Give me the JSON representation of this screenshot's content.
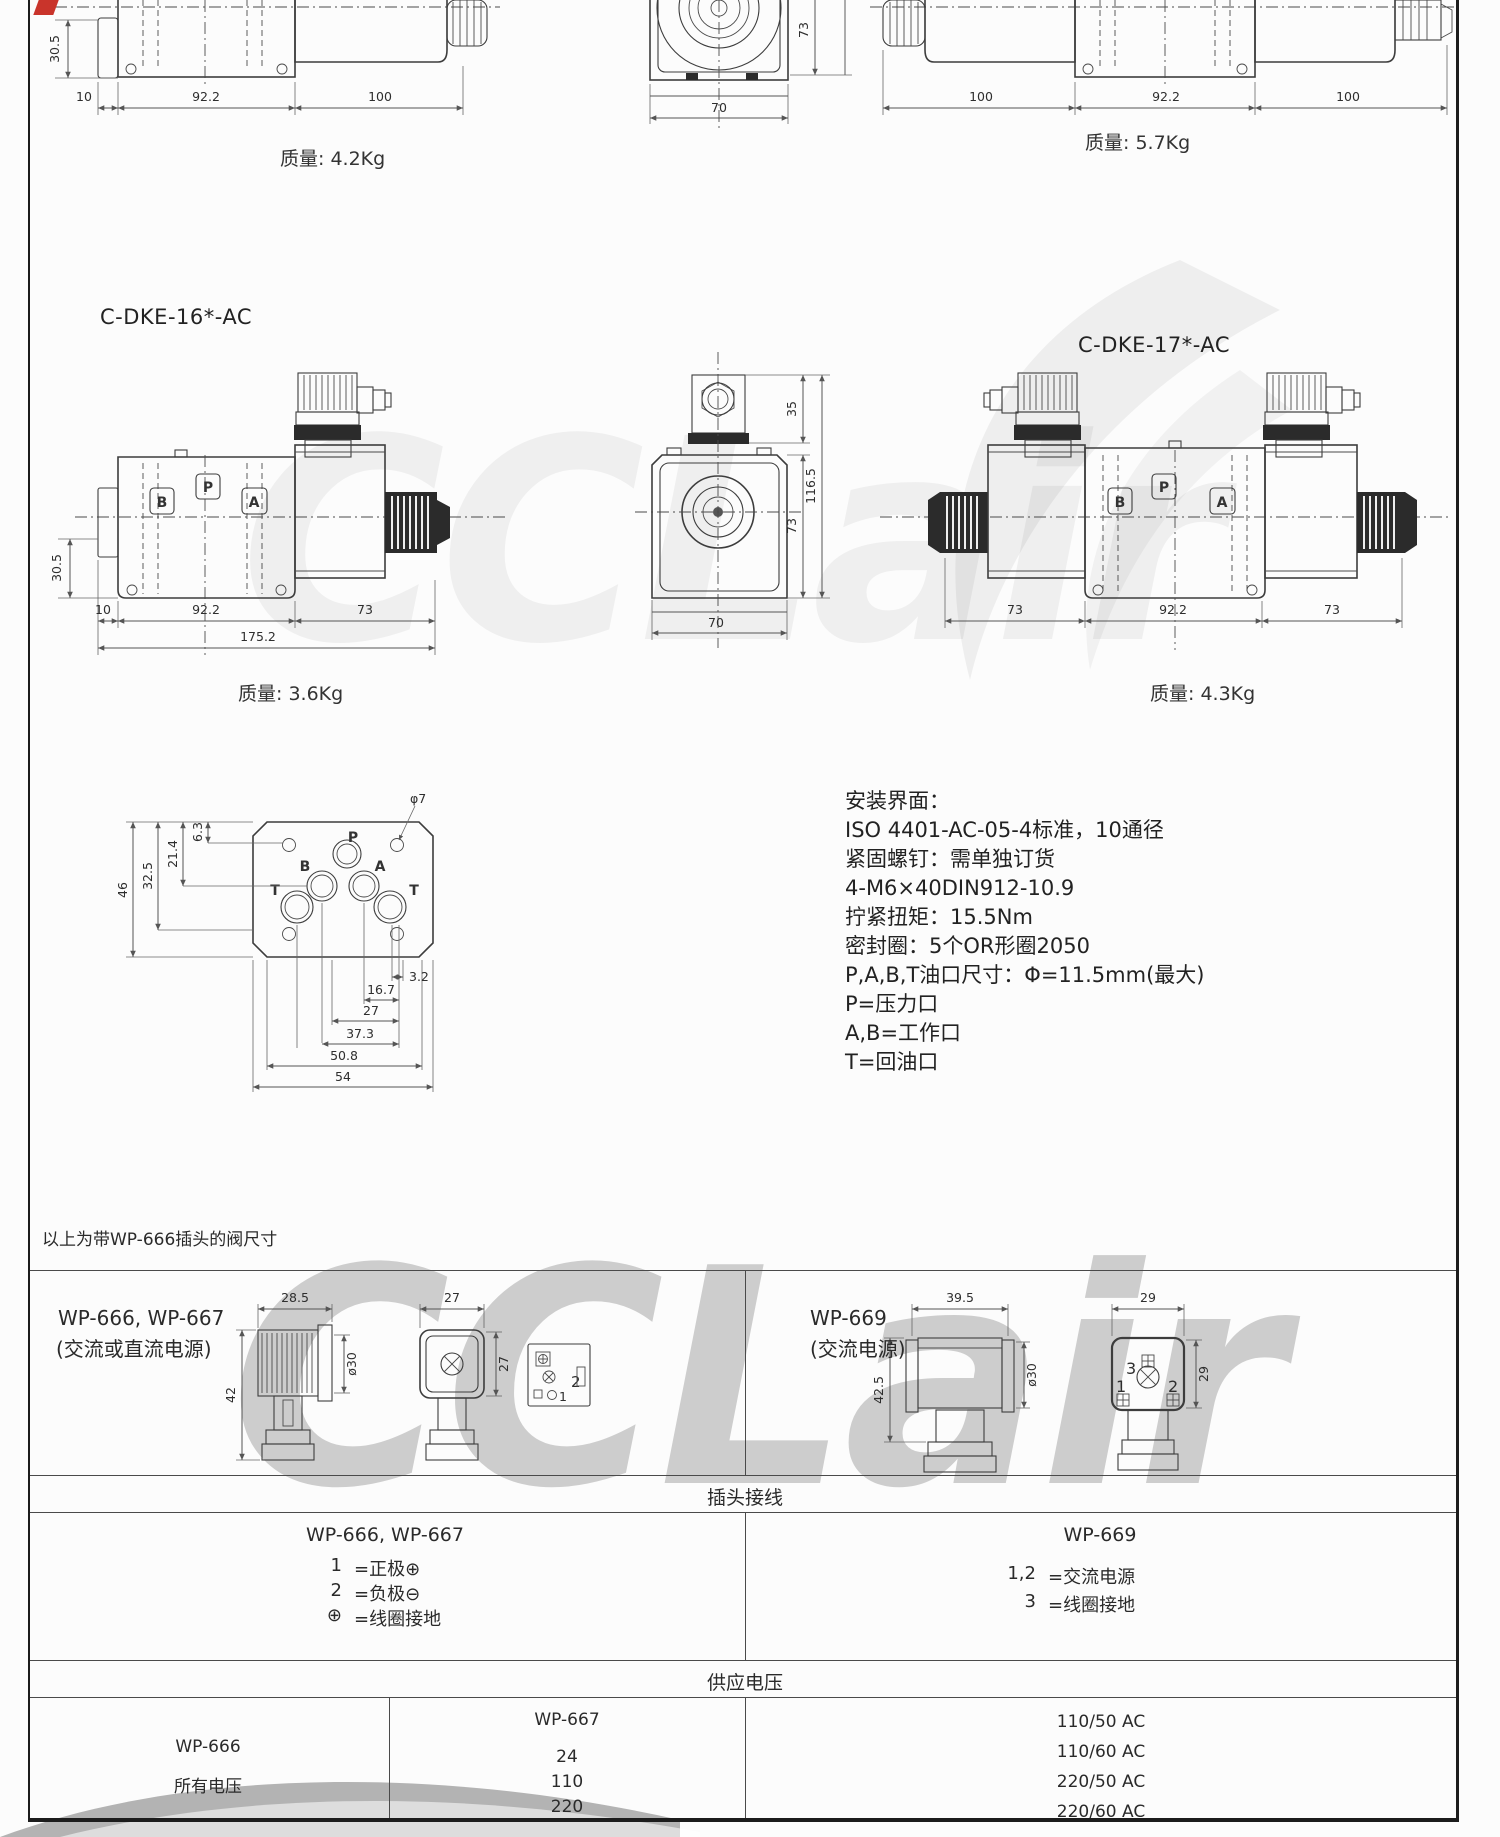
{
  "watermark": {
    "text": "CCLair"
  },
  "top_row": {
    "left": {
      "v_dim": "30.5",
      "dims": [
        "10",
        "92.2",
        "100"
      ],
      "weight": "质量: 4.2Kg"
    },
    "middle": {
      "side_dim": "73",
      "bottom_dim": "70"
    },
    "right": {
      "dims": [
        "100",
        "92.2",
        "100"
      ],
      "weight": "质量: 5.7Kg"
    }
  },
  "valve16": {
    "title": "C-DKE-16*-AC",
    "ports": [
      "B",
      "P",
      "A"
    ],
    "v_dim": "30.5",
    "dims": [
      "10",
      "92.2",
      "73"
    ],
    "total_dim": "175.2",
    "weight": "质量: 3.6Kg"
  },
  "end_view": {
    "dims_right": [
      "35",
      "116.5",
      "73"
    ],
    "bottom_dim": "70"
  },
  "valve17": {
    "title": "C-DKE-17*-AC",
    "ports": [
      "B",
      "P",
      "A"
    ],
    "dims": [
      "73",
      "92.2",
      "73"
    ],
    "weight": "质量: 4.3Kg"
  },
  "interface_diagram": {
    "callout": "φ7",
    "port_p": "P",
    "port_b": "B",
    "port_a": "A",
    "port_t1": "T",
    "port_t2": "T",
    "dims_left": [
      "6.3",
      "21.4",
      "32.5",
      "46"
    ],
    "dims_bottom": [
      "3.2",
      "16.7",
      "27",
      "37.3",
      "50.8",
      "54"
    ]
  },
  "mounting_info": {
    "lines": [
      "安装界面：",
      "ISO 4401-AC-05-4标准，10通径",
      "紧固螺钉：需单独订货",
      "4-M6×40DIN912-10.9",
      "拧紧扭矩：15.5Nm",
      "密封圈：5个OR形圈2050",
      "P,A,B,T油口尺寸：Φ=11.5mm(最大)",
      "P=压力口",
      "A,B=工作口",
      "T=回油口"
    ]
  },
  "note": "以上为带WP-666插头的阀尺寸",
  "connector_table": {
    "left_cell": {
      "title": "WP-666, WP-667",
      "subtitle": "(交流或直流电源)",
      "dims": [
        "28.5",
        "42",
        "ø30",
        "27",
        "27"
      ],
      "pins": [
        "1",
        "2"
      ]
    },
    "right_cell": {
      "title": "WP-669",
      "subtitle": "(交流电源)",
      "dims": [
        "39.5",
        "42.5",
        "ø30",
        "29",
        "29"
      ],
      "pins": [
        "1",
        "2",
        "3"
      ]
    }
  },
  "wiring_section": {
    "header": "插头接线",
    "left": {
      "title": "WP-666, WP-667",
      "rows": [
        [
          "1",
          "=正极⊕"
        ],
        [
          "2",
          "=负极⊖"
        ],
        [
          "⊕",
          "=线圈接地"
        ]
      ]
    },
    "right": {
      "title": "WP-669",
      "rows": [
        [
          "1,2",
          "=交流电源"
        ],
        [
          "3",
          "=线圈接地"
        ]
      ]
    }
  },
  "voltage_section": {
    "header": "供应电压",
    "col1": {
      "title": "WP-666",
      "value": "所有电压"
    },
    "col2": {
      "title": "WP-667",
      "values": [
        "24",
        "110",
        "220"
      ]
    },
    "col3": {
      "values": [
        "110/50 AC",
        "110/60 AC",
        "220/50 AC",
        "220/60 AC"
      ]
    }
  }
}
